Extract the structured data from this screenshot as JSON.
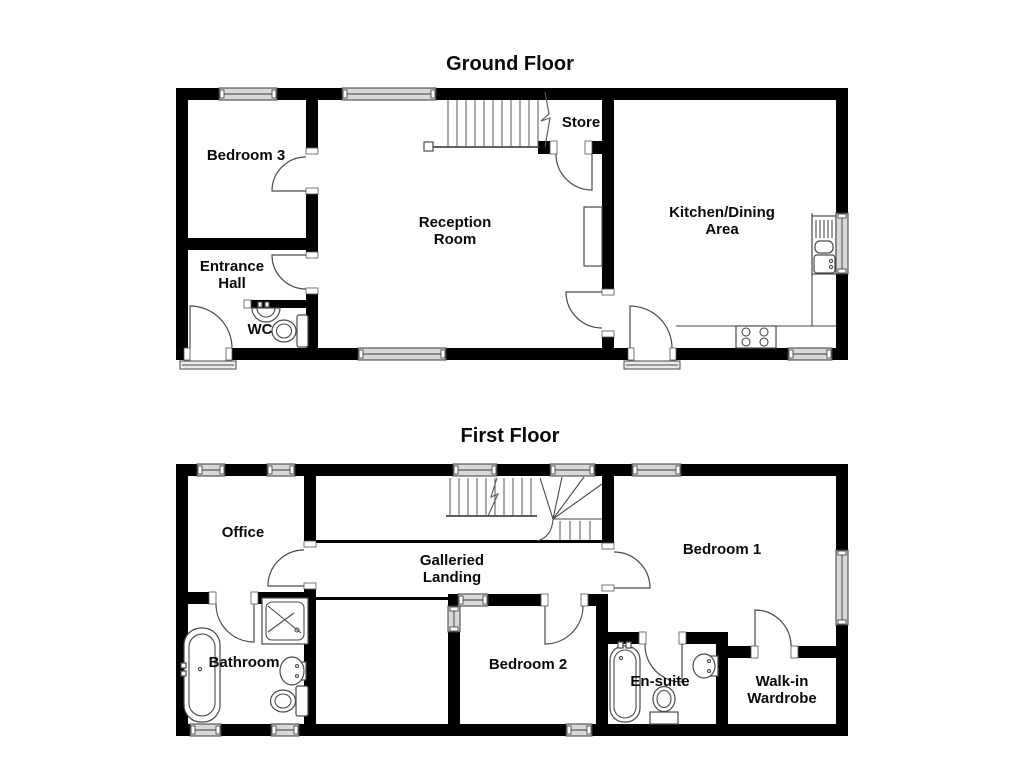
{
  "ground_floor": {
    "title": "Ground Floor",
    "rooms": {
      "bedroom3": {
        "label": "Bedroom 3"
      },
      "entrance_hall": {
        "line1": "Entrance",
        "line2": "Hall"
      },
      "wc": {
        "label": "WC"
      },
      "reception": {
        "line1": "Reception",
        "line2": "Room"
      },
      "store": {
        "label": "Store"
      },
      "kitchen": {
        "line1": "Kitchen/Dining",
        "line2": "Area"
      }
    }
  },
  "first_floor": {
    "title": "First Floor",
    "rooms": {
      "office": {
        "label": "Office"
      },
      "galleried_landing": {
        "line1": "Galleried",
        "line2": "Landing"
      },
      "bathroom": {
        "label": "Bathroom"
      },
      "bedroom2": {
        "label": "Bedroom 2"
      },
      "bedroom1": {
        "label": "Bedroom 1"
      },
      "ensuite": {
        "label": "En-suite"
      },
      "walkin_wardrobe": {
        "line1": "Walk-in",
        "line2": "Wardrobe"
      }
    }
  },
  "colors": {
    "wall": "#000000",
    "window_fill": "#d8d8d8",
    "fixture_stroke": "#4a4a4a",
    "background": "#ffffff"
  }
}
